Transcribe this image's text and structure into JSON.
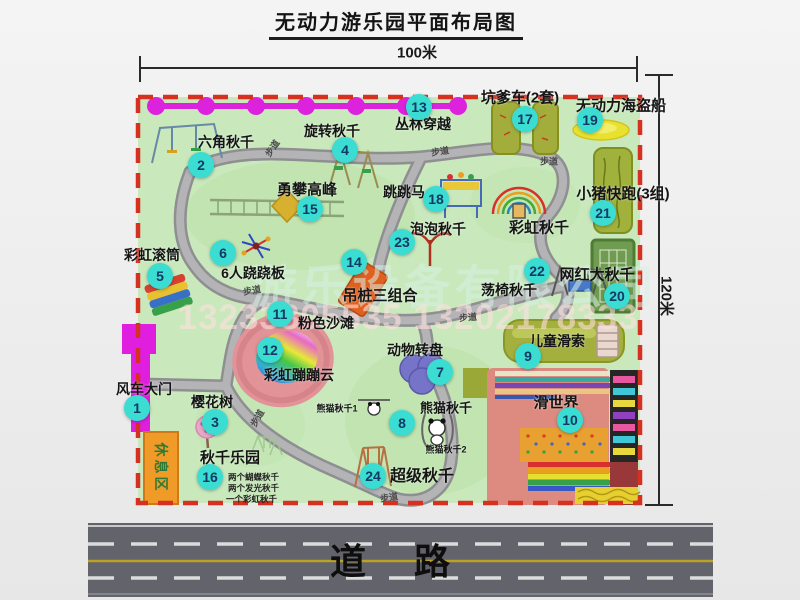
{
  "title": "无动力游乐园平面布局图",
  "dims": {
    "width": "100米",
    "height": "120米"
  },
  "road_label": "道路",
  "walkway_label": "步道",
  "rest_area_label": "休息区",
  "rainbow_swing_label": "彩虹秋千",
  "watermark": {
    "company": "游乐设备有限公司",
    "phone": "13233805535 13202178333"
  },
  "colors": {
    "map_green": "#c9e9bd",
    "border_red": "#d63020",
    "badge_cyan": "#3bdcd2",
    "gate_magenta": "#e01ee0",
    "road_gray": "#63636b",
    "rest_orange": "#f09a28"
  },
  "attractions": [
    {
      "num": "1",
      "label": "风车大门"
    },
    {
      "num": "2",
      "label": "六角秋千"
    },
    {
      "num": "3",
      "label": "樱花树"
    },
    {
      "num": "4",
      "label": "旋转秋千"
    },
    {
      "num": "5",
      "label": "彩虹滚筒"
    },
    {
      "num": "6",
      "label": "6人跷跷板"
    },
    {
      "num": "7",
      "label": "动物转盘"
    },
    {
      "num": "8",
      "label": "熊猫秋千",
      "sub1": "熊猫秋千1",
      "sub2": "熊猫秋千2"
    },
    {
      "num": "9",
      "label": "儿童滑索"
    },
    {
      "num": "10",
      "label": "滑世界"
    },
    {
      "num": "11",
      "label": "粉色沙滩"
    },
    {
      "num": "12",
      "label": "彩虹蹦蹦云"
    },
    {
      "num": "13",
      "label": "丛林穿越"
    },
    {
      "num": "14",
      "label": "吊桩三组合"
    },
    {
      "num": "15",
      "label": "勇攀高峰"
    },
    {
      "num": "16",
      "label": "秋千乐园",
      "notes": [
        "两个蝴蝶秋千",
        "两个发光秋千",
        "一个彩虹秋千"
      ]
    },
    {
      "num": "17",
      "label": "坑爹车(2套)"
    },
    {
      "num": "18",
      "label": "跳跳马"
    },
    {
      "num": "19",
      "label": "无动力海盗船"
    },
    {
      "num": "20",
      "label": "网红大秋千"
    },
    {
      "num": "21",
      "label": "小猪快跑(3组)"
    },
    {
      "num": "22",
      "label": "荡椅秋千"
    },
    {
      "num": "23",
      "label": "泡泡秋千"
    },
    {
      "num": "24",
      "label": "超级秋千"
    }
  ]
}
